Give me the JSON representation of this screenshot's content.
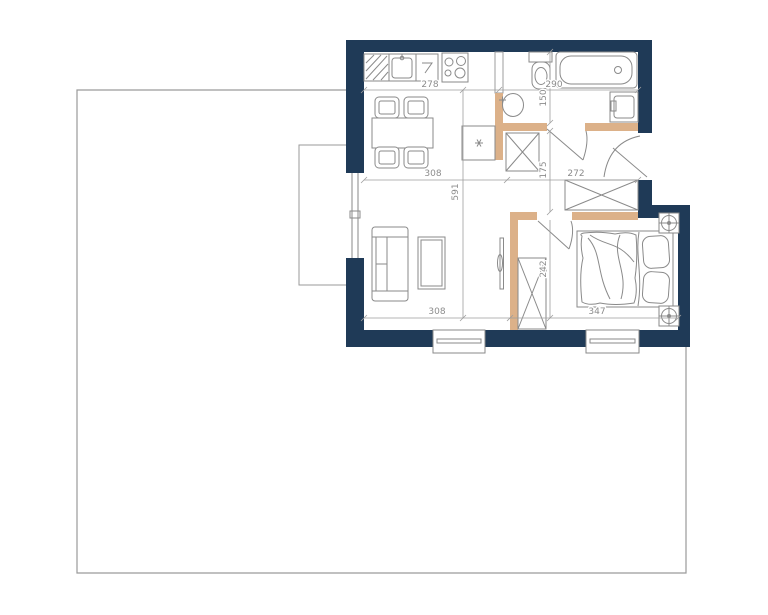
{
  "floor_plan": {
    "colors": {
      "wall": "#1f3a57",
      "partition": "#dcb189",
      "drawing_line": "#8a8a8a",
      "dimension_line": "#9e9e9e",
      "dimension_text": "#8c8c8c",
      "site_boundary": "#9a9a9a"
    },
    "dimensions": {
      "kitchen_width": "278",
      "bathroom_width": "290",
      "bathroom_depth": "150",
      "living_width": "308",
      "apartment_depth": "591",
      "hall_depth": "175",
      "hall_width": "272",
      "bedroom_depth": "242",
      "living_width_bottom": "308",
      "bedroom_width": "347"
    }
  }
}
